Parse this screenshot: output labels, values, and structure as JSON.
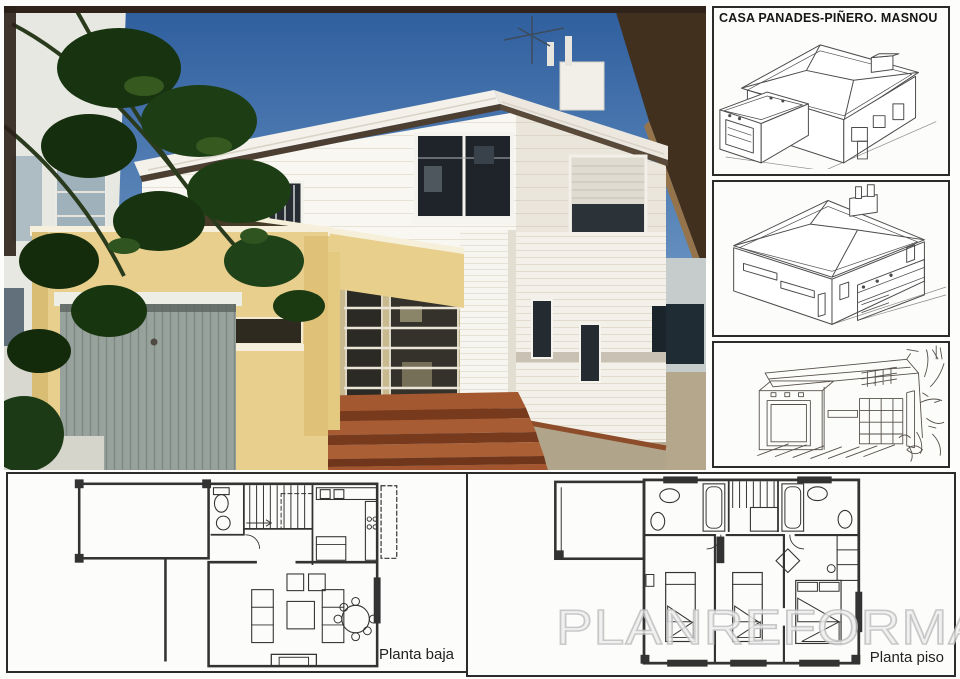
{
  "title_block": {
    "text": "CASA PANADES-PIÑERO. MASNOU"
  },
  "floor_plans": {
    "ground": {
      "label": "Planta baja"
    },
    "upper": {
      "label": "Planta piso"
    }
  },
  "watermark": {
    "text": "PLANREFORMA"
  },
  "palette": {
    "sky_blue": "#3f6ca8",
    "facade_yellow": "#e9cf8d",
    "step_terracotta": "#9a5330",
    "drawing_ink": "#4b4b4b",
    "watermark_gray": "#c0c0c0"
  }
}
